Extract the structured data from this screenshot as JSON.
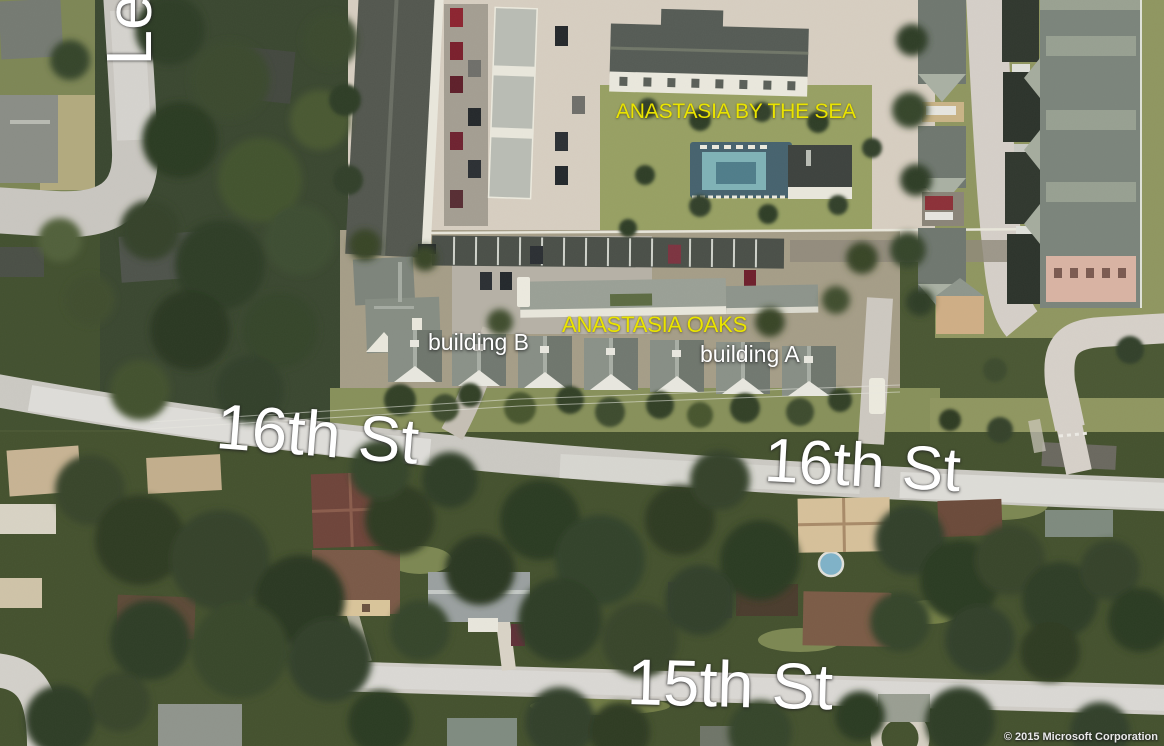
{
  "map": {
    "view": "aerial-birdseye",
    "labels": {
      "street_left_vertical": {
        "text": "Le"
      },
      "complex_north": {
        "text": "ANASTASIA BY THE SEA"
      },
      "complex_central": {
        "text": "ANASTASIA OAKS"
      },
      "building_b": {
        "text": "building B"
      },
      "building_a": {
        "text": "building A"
      },
      "street_16_west": {
        "text": "16th St"
      },
      "street_16_east": {
        "text": "16th St"
      },
      "street_15": {
        "text": "15th St"
      }
    },
    "attribution": "© 2015 Microsoft Corporation",
    "colors": {
      "label_yellow": "#eae400",
      "label_white": "#ffffff",
      "road": "#cfccc6"
    }
  }
}
